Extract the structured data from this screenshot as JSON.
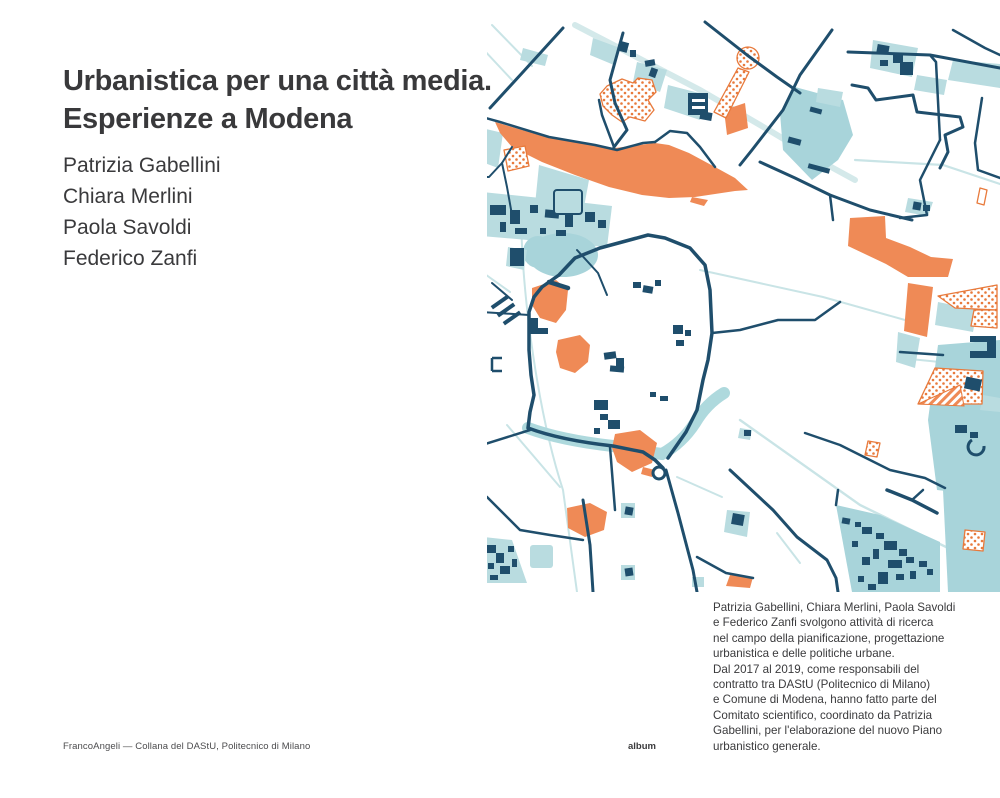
{
  "cover": {
    "title_lines": [
      "Urbanistica per una città media.",
      "Esperienze a Modena"
    ],
    "authors": [
      "Patrizia Gabellini",
      "Chiara Merlini",
      "Paola Savoldi",
      "Federico Zanfi"
    ],
    "bio_lines": [
      "Patrizia Gabellini, Chiara Merlini, Paola Savoldi",
      "e Federico Zanfi svolgono attività di ricerca",
      "nel campo della pianificazione, progettazione",
      "urbanistica e delle politiche urbane.",
      "Dal 2017 al 2019, come responsabili del",
      "contratto tra DAStU (Politecnico di Milano)",
      "e Comune di Modena, hanno fatto parte del",
      "Comitato scientifico, coordinato da Patrizia",
      "Gabellini, per l'elaborazione del nuovo Piano",
      "urbanistico generale."
    ],
    "imprint": "FrancoAngeli — Collana del DAStU, Politecnico di Milano",
    "series_label": "album"
  },
  "map": {
    "description": "Stylized plan of Modena: historic centre ring, railway band, parks and built fabric",
    "palette": {
      "navy": "#1f4e6c",
      "teal_light": "#b9dce0",
      "teal_deep": "#a8d4da",
      "teal_line_pale": "#c9e4e6",
      "orange": "#ef8a56",
      "pattern_orange": "#e87a3c",
      "background": "#ffffff",
      "text": "#3a3a3c"
    }
  }
}
